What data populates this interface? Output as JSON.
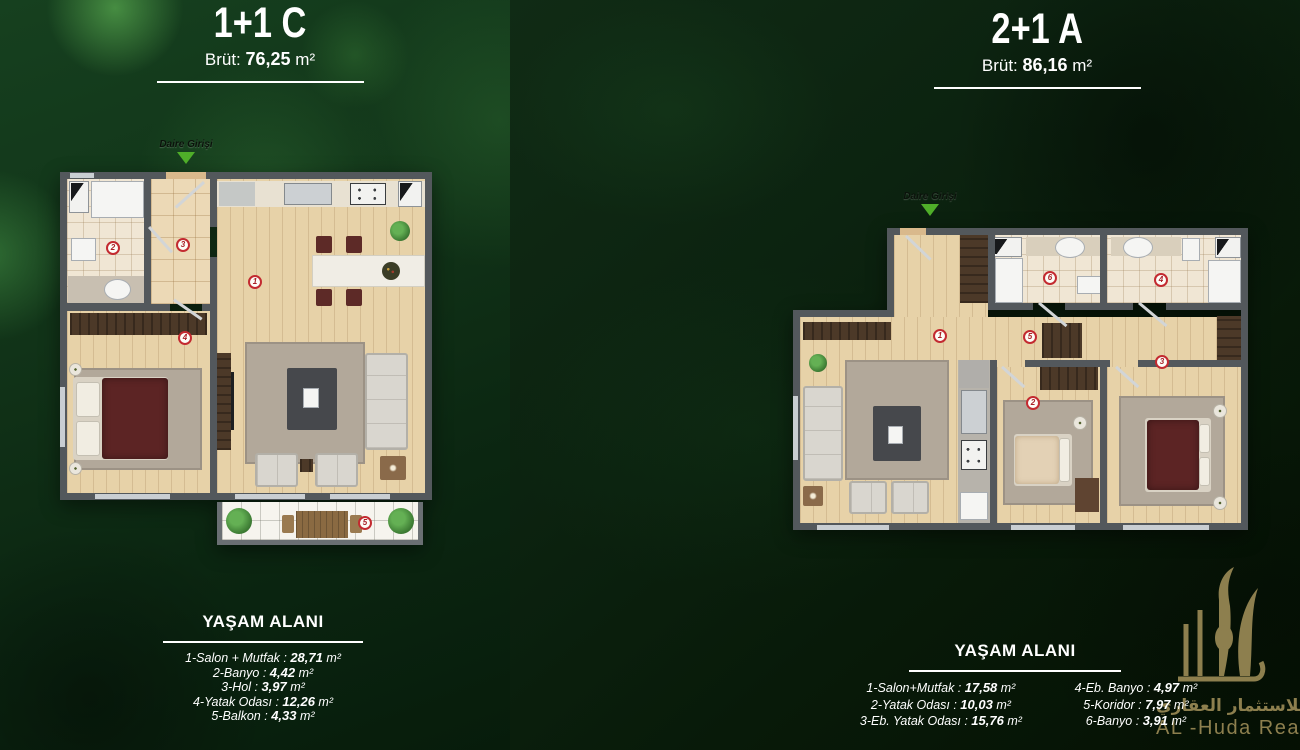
{
  "colors": {
    "accent_green": "#4fae29",
    "marker_red": "#c32a30",
    "logo_gold": "#8d7f4e",
    "panel_green_left": "#123a1c",
    "panel_green_right": "#0a1c0d"
  },
  "gross_label": "Brüt:",
  "area_unit": " m²",
  "sep": " : ",
  "entrance_label": "Daire Girişi",
  "area_heading": "YAŞAM ALANI",
  "units": [
    {
      "title": "1+1 C",
      "gross_value": "76,25",
      "rooms": [
        {
          "label": "1-Salon + Mutfak",
          "value": "28,71"
        },
        {
          "label": "2-Banyo",
          "value": "4,42"
        },
        {
          "label": "3-Hol",
          "value": "3,97"
        },
        {
          "label": "4-Yatak Odası",
          "value": "12,26"
        },
        {
          "label": "5-Balkon",
          "value": "4,33"
        }
      ],
      "markers": [
        "1",
        "2",
        "3",
        "4",
        "5"
      ]
    },
    {
      "title": "2+1 A",
      "gross_value": "86,16",
      "rooms_col1": [
        {
          "label": "1-Salon+Mutfak",
          "value": "17,58"
        },
        {
          "label": "2-Yatak Odası",
          "value": "10,03"
        },
        {
          "label": "3-Eb. Yatak Odası",
          "value": "15,76"
        }
      ],
      "rooms_col2": [
        {
          "label": "4-Eb. Banyo",
          "value": "4,97"
        },
        {
          "label": "5-Koridor",
          "value": "7,97"
        },
        {
          "label": "6-Banyo",
          "value": "3,91"
        }
      ],
      "markers": [
        "1",
        "2",
        "3",
        "4",
        "5",
        "6"
      ]
    }
  ],
  "logo": {
    "arabic": "الهدى للاستثمار العقاري",
    "english": "AL -Huda Real Estate"
  }
}
